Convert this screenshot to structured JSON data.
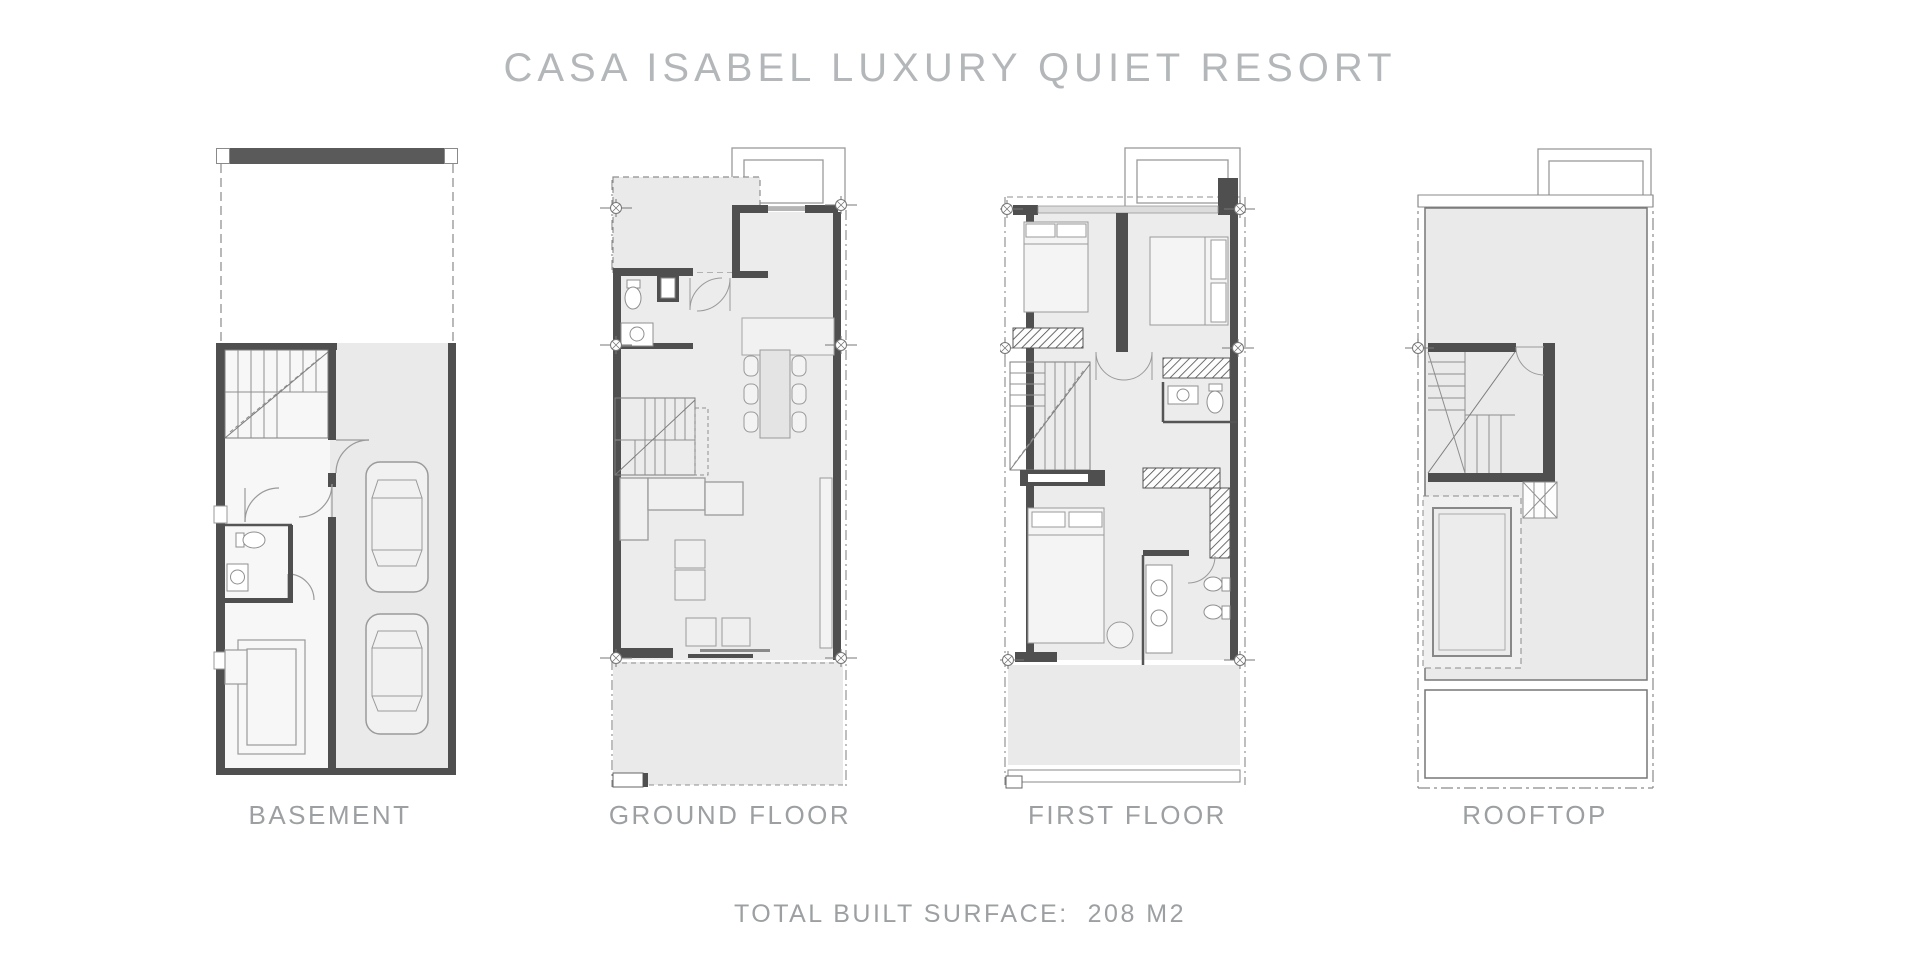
{
  "header": {
    "title": "CASA ISABEL LUXURY QUIET RESORT"
  },
  "plans": [
    {
      "id": "basement",
      "label": "BASEMENT"
    },
    {
      "id": "ground-floor",
      "label": "GROUND FLOOR"
    },
    {
      "id": "first-floor",
      "label": "FIRST FLOOR"
    },
    {
      "id": "rooftop",
      "label": "ROOFTOP"
    }
  ],
  "footer": {
    "text": "TOTAL BUILT SURFACE:  208 M2"
  },
  "colors": {
    "title_text": "#b4b7b9",
    "caption_text": "#9da0a2",
    "wall_dark": "#4f4f4f",
    "floor_fill": "#e9eae9",
    "furniture_line": "#9a9a9a",
    "boundary_line": "#8a8a8a"
  }
}
